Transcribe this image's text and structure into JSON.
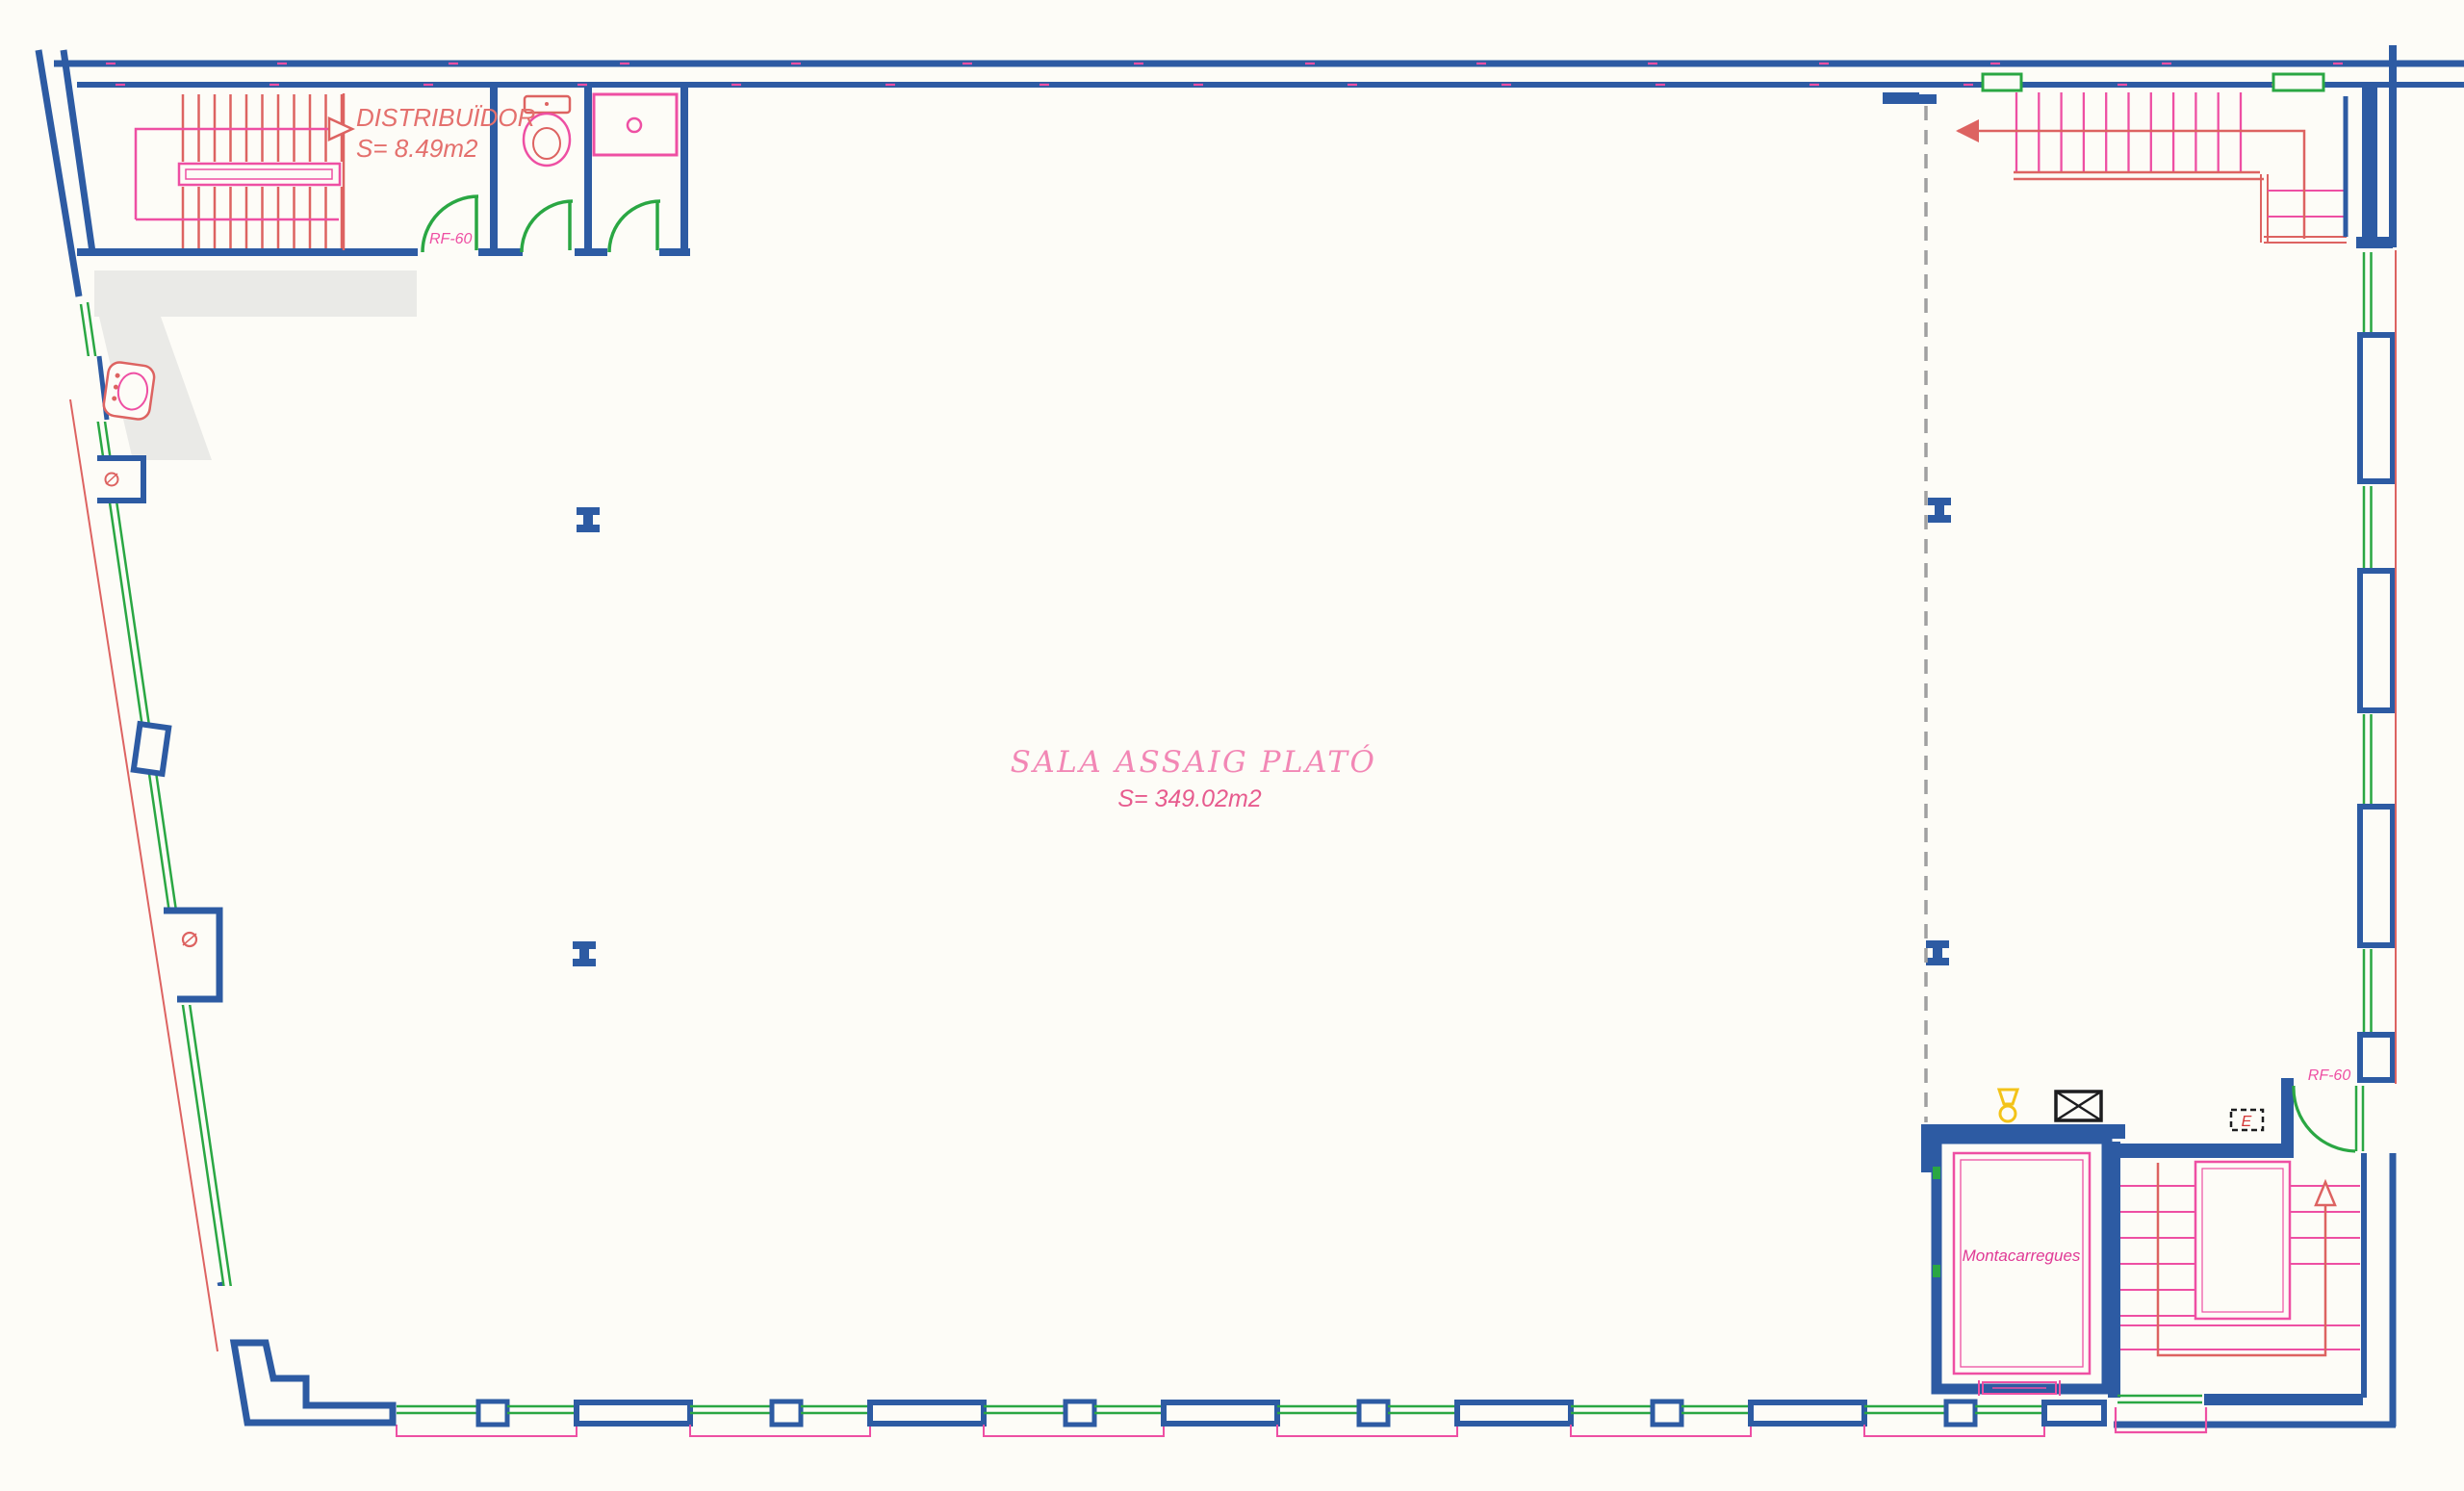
{
  "plan": {
    "rooms": {
      "distribuidor": {
        "name": "DISTRIBUÏDOR",
        "area": "S= 8.49m2"
      },
      "sala_assaig": {
        "name": "SALA ASSAIG PLATÓ",
        "area": "S= 349.02m2"
      },
      "montacarregues": {
        "name": "Montacarregues"
      }
    },
    "fire_labels": {
      "top_left": "RF-60",
      "bottom_right": "RF-60"
    },
    "symbols": {
      "elevator_letter": "E"
    },
    "colors": {
      "wall_blue": "#2d5ba3",
      "window_green": "#2aa743",
      "pink_magenta": "#ee4fa3",
      "tread_salmon": "#dd6361",
      "label_pink": "#f287b5",
      "label_red_pink": "#e4706d",
      "symbol_yellow": "#f3c319",
      "dashed_gray": "#a0a0a0",
      "shade_gray": "#eaeae7",
      "detail_black": "#1d1d1f"
    }
  }
}
